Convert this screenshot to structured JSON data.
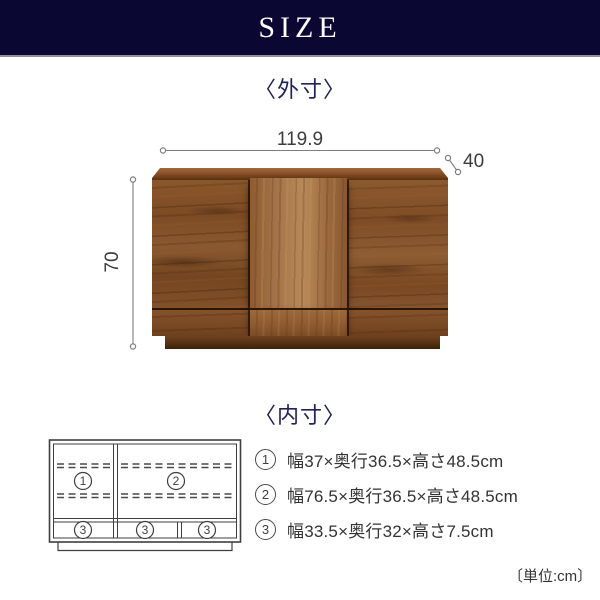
{
  "header": {
    "title": "SIZE"
  },
  "outer_section": {
    "heading": "〈外寸〉",
    "dimensions": {
      "width": "119.9",
      "depth": "40",
      "height": "70"
    }
  },
  "inner_section": {
    "heading": "〈内寸〉",
    "diagram_labels": {
      "compartment1": "1",
      "compartment2": "2",
      "drawer1": "3",
      "drawer2": "3",
      "drawer3": "3"
    },
    "specs": [
      {
        "num": "1",
        "text": "幅37×奥行36.5×高さ48.5cm"
      },
      {
        "num": "2",
        "text": "幅76.5×奥行36.5×高さ48.5cm"
      },
      {
        "num": "3",
        "text": "幅33.5×奥行32×高さ7.5cm"
      }
    ],
    "unit_note": "〔単位:cm〕"
  },
  "colors": {
    "header_bg": "#0a0733",
    "heading_text": "#222257",
    "dimension_line": "#7d7d7d",
    "spec_text": "#333333",
    "wood_dark": "#7c4a24",
    "wood_light": "#b88a58",
    "plinth": "#4a2b11"
  }
}
